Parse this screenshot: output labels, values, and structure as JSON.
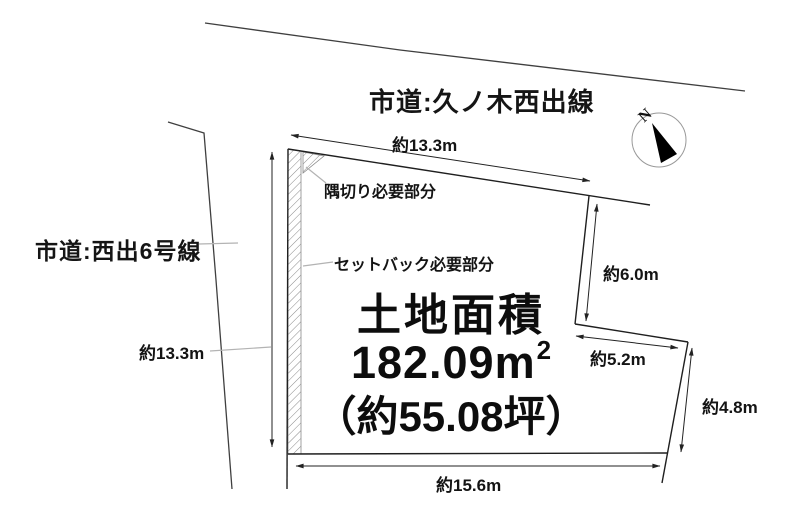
{
  "roads": {
    "north_label": "市道:久ノ木西出線",
    "west_label": "市道:西出6号線"
  },
  "area": {
    "title": "土地面積",
    "square_meters": "182.09",
    "unit": "m",
    "unit_sup": "2",
    "tsubo": "（約55.08坪）"
  },
  "dimensions": {
    "top_frontage": "約13.3m",
    "west_side": "約13.3m",
    "upper_east": "約6.0m",
    "step": "約5.2m",
    "lower_east": "約4.8m",
    "bottom": "約15.6m"
  },
  "annotations": {
    "corner_cut": "隅切り必要部分",
    "setback": "セットバック必要部分"
  },
  "compass": {
    "north": "N"
  },
  "colors": {
    "boundary_line": "#1f1f1f",
    "road_line": "#3f3f3f",
    "dimension_line": "#222222",
    "leader_line": "#b3b3b3",
    "hatch_line": "#8a8a8a",
    "needle": "#000000"
  }
}
